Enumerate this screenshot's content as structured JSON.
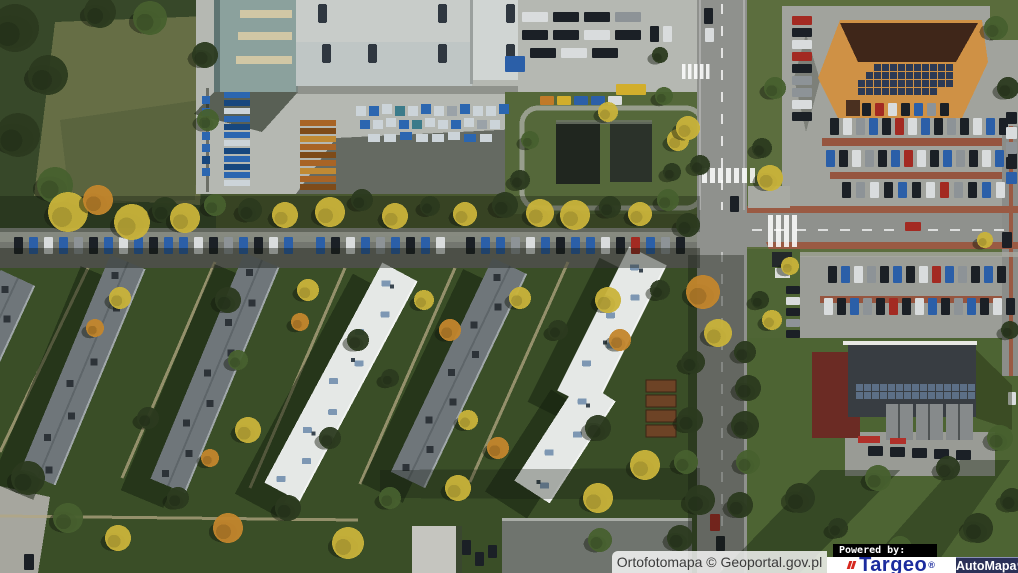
{
  "map": {
    "type": "orthophoto-aerial",
    "description": "Aerial orthophoto of a neighborhood: industrial hall with storage yard (top), main road with intersection (right), retail building with solar roof and parking lots (top right), service building with solar panels (bottom right), six diagonal apartment blocks with lawns, trees and street parking (center/left)"
  },
  "attribution": {
    "source": "Ortofotomapa © Geoportal.gov.pl",
    "powered_by": "Powered by:",
    "brand_targeo": "Targeo",
    "brand_targeo_reg": "®",
    "brand_automapa": "AutoMapa",
    "brand_automapa_reg": "®"
  },
  "colors": {
    "targeo_blue": "#1c2c9e",
    "targeo_red": "#d6281e",
    "automapa_navy": "#2b3158",
    "attribution_text": "#3b3b3b",
    "powered_by_bg": "#000000",
    "powered_by_text": "#ffffff"
  },
  "scene": {
    "palette": {
      "cars": {
        "n": "#1b2026",
        "b": "#2b5fa8",
        "w": "#d9dcdd",
        "s": "#8d9397",
        "r": "#a32a22",
        "y": "#d2ae2c",
        "o": "#c07a28"
      },
      "trees": {
        "d": "#2b3a1f",
        "m": "#47602e",
        "y": "#c9b33a",
        "o": "#c3862c",
        "l": "#6e8440"
      },
      "pallets": {
        "b": "#2b66b0",
        "B": "#17477e",
        "w": "#ccd4d9",
        "o": "#a86426",
        "O": "#7e4b19",
        "c": "#c08a34",
        "t": "#3b7b8a",
        "s": "#9aa2a8"
      }
    },
    "street_cars": {
      "y": 237,
      "w": 9,
      "h": 17,
      "xs": [
        14,
        29,
        44,
        59,
        74,
        89,
        104,
        119,
        134,
        149,
        164,
        179,
        194,
        209,
        224,
        239,
        254,
        269,
        284,
        316,
        331,
        346,
        361,
        376,
        391,
        406,
        421,
        436,
        466,
        481,
        496,
        511,
        526,
        541,
        556,
        571,
        586,
        601,
        616,
        631,
        646,
        661,
        676
      ],
      "colors": "nbwbsnbwbnbbwnsbnwbbnwbsbnbwnbbswbnbbwnrbsn"
    },
    "rows": [
      {
        "x": 830,
        "y": 118,
        "n": 14,
        "dx": 13,
        "dy": 0,
        "w": 9,
        "h": 17,
        "c": "nwsbnrwbnsnwbn"
      },
      {
        "x": 826,
        "y": 150,
        "n": 15,
        "dx": 13,
        "dy": 0,
        "w": 9,
        "h": 17,
        "c": "bnwsnbrwnbsnwbn"
      },
      {
        "x": 842,
        "y": 182,
        "n": 12,
        "dx": 14,
        "dy": 0,
        "w": 9,
        "h": 16,
        "c": "nswnbnwrsnbw"
      },
      {
        "x": 792,
        "y": 16,
        "n": 9,
        "dx": 0,
        "dy": 12,
        "w": 20,
        "h": 9,
        "c": "rnwrnsswn"
      },
      {
        "x": 862,
        "y": 103,
        "n": 7,
        "dx": 13,
        "dy": 0,
        "w": 9,
        "h": 13,
        "c": "nrwnbsn"
      },
      {
        "x": 828,
        "y": 266,
        "n": 14,
        "dx": 13,
        "dy": 0,
        "w": 9,
        "h": 17,
        "c": "nbwsnbnwrbsnbn"
      },
      {
        "x": 824,
        "y": 298,
        "n": 15,
        "dx": 13,
        "dy": 0,
        "w": 9,
        "h": 17,
        "c": "wnbsnrnwbnsbnwn"
      },
      {
        "x": 522,
        "y": 12,
        "n": 4,
        "dx": 31,
        "dy": 0,
        "w": 26,
        "h": 10,
        "c": "wnns"
      },
      {
        "x": 522,
        "y": 30,
        "n": 4,
        "dx": 31,
        "dy": 0,
        "w": 26,
        "h": 10,
        "c": "nnwn"
      },
      {
        "x": 530,
        "y": 48,
        "n": 3,
        "dx": 31,
        "dy": 0,
        "w": 26,
        "h": 10,
        "c": "nwn"
      },
      {
        "x": 540,
        "y": 96,
        "n": 5,
        "dx": 17,
        "dy": 0,
        "w": 14,
        "h": 9,
        "c": "oybbw"
      },
      {
        "x": 786,
        "y": 286,
        "n": 5,
        "dx": 0,
        "dy": 11,
        "w": 14,
        "h": 8,
        "c": "nwnsn"
      },
      {
        "x": 1006,
        "y": 112,
        "n": 5,
        "dx": 0,
        "dy": 15,
        "w": 11,
        "h": 12,
        "c": "nwsnb"
      },
      {
        "x": 868,
        "y": 446,
        "n": 5,
        "dx": 22,
        "dy": 1,
        "w": 15,
        "h": 10,
        "c": "nnnnn"
      }
    ],
    "vehicles": [
      [
        616,
        84,
        30,
        11,
        "y"
      ],
      [
        505,
        56,
        20,
        16,
        "b"
      ],
      [
        650,
        26,
        9,
        16,
        "n"
      ],
      [
        663,
        26,
        9,
        16,
        "w"
      ],
      [
        704,
        8,
        9,
        16,
        "n"
      ],
      [
        705,
        28,
        9,
        14,
        "w"
      ],
      [
        730,
        196,
        9,
        16,
        "n"
      ],
      [
        905,
        222,
        16,
        9,
        "r"
      ],
      [
        710,
        514,
        10,
        17,
        "r"
      ],
      [
        716,
        536,
        9,
        15,
        "n"
      ],
      [
        24,
        554,
        10,
        16,
        "n"
      ],
      [
        1002,
        232,
        10,
        16,
        "n"
      ],
      [
        1008,
        392,
        8,
        13,
        "w"
      ],
      [
        462,
        540,
        9,
        15,
        "n"
      ],
      [
        475,
        552,
        9,
        14,
        "n"
      ],
      [
        488,
        545,
        9,
        13,
        "n"
      ]
    ],
    "pallet_stacks": [
      {
        "x": 224,
        "y": 92,
        "n": 12,
        "dx": 0,
        "dy": 8,
        "w": 26,
        "h": 6,
        "c": "bBwbBbwBbBbw"
      },
      {
        "x": 202,
        "y": 96,
        "n": 7,
        "dx": 0,
        "dy": 12,
        "w": 8,
        "h": 8,
        "c": "bbBbbBb"
      },
      {
        "x": 300,
        "y": 120,
        "n": 9,
        "dx": 0,
        "dy": 8,
        "w": 36,
        "h": 6,
        "c": "oOcoOocoO"
      }
    ],
    "yard_items": [
      [
        356,
        106,
        10,
        10,
        "w"
      ],
      [
        369,
        106,
        10,
        10,
        "b"
      ],
      [
        382,
        104,
        10,
        10,
        "w"
      ],
      [
        395,
        106,
        10,
        10,
        "t"
      ],
      [
        408,
        106,
        10,
        10,
        "w"
      ],
      [
        421,
        104,
        10,
        10,
        "b"
      ],
      [
        434,
        106,
        10,
        10,
        "w"
      ],
      [
        447,
        106,
        10,
        10,
        "s"
      ],
      [
        460,
        104,
        10,
        10,
        "b"
      ],
      [
        473,
        106,
        10,
        10,
        "w"
      ],
      [
        486,
        106,
        10,
        10,
        "w"
      ],
      [
        499,
        104,
        10,
        10,
        "b"
      ],
      [
        360,
        120,
        10,
        9,
        "b"
      ],
      [
        373,
        120,
        10,
        9,
        "w"
      ],
      [
        386,
        118,
        10,
        9,
        "w"
      ],
      [
        399,
        120,
        10,
        9,
        "b"
      ],
      [
        412,
        120,
        10,
        9,
        "t"
      ],
      [
        425,
        118,
        10,
        9,
        "w"
      ],
      [
        438,
        120,
        10,
        9,
        "w"
      ],
      [
        451,
        120,
        10,
        9,
        "b"
      ],
      [
        464,
        118,
        10,
        9,
        "w"
      ],
      [
        477,
        120,
        10,
        9,
        "s"
      ],
      [
        490,
        120,
        10,
        9,
        "w"
      ],
      [
        368,
        134,
        12,
        8,
        "w"
      ],
      [
        384,
        134,
        12,
        8,
        "w"
      ],
      [
        400,
        132,
        12,
        8,
        "b"
      ],
      [
        416,
        134,
        12,
        8,
        "w"
      ],
      [
        432,
        134,
        12,
        8,
        "w"
      ],
      [
        448,
        132,
        12,
        8,
        "w"
      ],
      [
        464,
        134,
        12,
        8,
        "b"
      ],
      [
        480,
        134,
        12,
        8,
        "w"
      ]
    ],
    "buildings": [
      {
        "x1": 18,
        "y1": 278,
        "x2": -70,
        "y2": 468,
        "w": 38,
        "roof": "gray"
      },
      {
        "x1": 128,
        "y1": 262,
        "x2": 38,
        "y2": 478,
        "w": 38,
        "roof": "gray"
      },
      {
        "x1": 262,
        "y1": 260,
        "x2": 168,
        "y2": 486,
        "w": 38,
        "roof": "gray"
      },
      {
        "x1": 400,
        "y1": 272,
        "x2": 282,
        "y2": 492,
        "w": 40,
        "roof": "white"
      },
      {
        "x1": 510,
        "y1": 266,
        "x2": 408,
        "y2": 480,
        "w": 38,
        "roof": "gray"
      },
      {
        "x1": 648,
        "y1": 256,
        "x2": 576,
        "y2": 400,
        "w": 42,
        "roof": "white"
      },
      {
        "x1": 598,
        "y1": 390,
        "x2": 532,
        "y2": 492,
        "w": 42,
        "roof": "white"
      }
    ],
    "skylights": [
      [
        318,
        4
      ],
      [
        438,
        4
      ],
      [
        506,
        4
      ],
      [
        322,
        44
      ],
      [
        368,
        44
      ],
      [
        438,
        44
      ],
      [
        506,
        44
      ]
    ],
    "solar_orange": [
      [
        64,
        874,
        10
      ],
      [
        72,
        866,
        11
      ],
      [
        80,
        858,
        12
      ],
      [
        88,
        858,
        10
      ]
    ],
    "solar_maroon": [
      [
        384,
        856,
        15
      ],
      [
        392,
        856,
        15
      ]
    ],
    "zebras": [
      {
        "x": 702,
        "y": 168,
        "n": 7,
        "dx": 8,
        "w": 5,
        "h": 15
      },
      {
        "x": 768,
        "y": 215,
        "n": 4,
        "dx": 8,
        "w": 5,
        "h": 32
      },
      {
        "x": 682,
        "y": 64,
        "n": 5,
        "dx": 6,
        "w": 3.5,
        "h": 15
      }
    ],
    "garages": {
      "x": 646,
      "y": 380,
      "n": 4,
      "dy": 15,
      "w": 30,
      "h": 12
    },
    "paths": [
      [
        88,
        268,
        0,
        452
      ],
      [
        215,
        262,
        122,
        478
      ],
      [
        345,
        268,
        250,
        488
      ],
      [
        455,
        268,
        360,
        484
      ],
      [
        568,
        262,
        470,
        482
      ],
      [
        0,
        516,
        358,
        520
      ]
    ],
    "trees": [
      [
        15,
        28,
        24,
        "d"
      ],
      [
        48,
        75,
        20,
        "d"
      ],
      [
        18,
        135,
        22,
        "d"
      ],
      [
        55,
        185,
        18,
        "m"
      ],
      [
        100,
        12,
        16,
        "d"
      ],
      [
        150,
        18,
        17,
        "m"
      ],
      [
        205,
        55,
        13,
        "d"
      ],
      [
        208,
        120,
        11,
        "m"
      ],
      [
        68,
        212,
        20,
        "y"
      ],
      [
        98,
        200,
        15,
        "o"
      ],
      [
        132,
        222,
        18,
        "y"
      ],
      [
        165,
        210,
        13,
        "d"
      ],
      [
        185,
        218,
        15,
        "y"
      ],
      [
        215,
        205,
        11,
        "m"
      ],
      [
        250,
        210,
        12,
        "d"
      ],
      [
        285,
        215,
        13,
        "y"
      ],
      [
        330,
        212,
        15,
        "y"
      ],
      [
        362,
        200,
        11,
        "d"
      ],
      [
        395,
        216,
        13,
        "y"
      ],
      [
        430,
        206,
        10,
        "d"
      ],
      [
        465,
        214,
        12,
        "y"
      ],
      [
        505,
        205,
        13,
        "d"
      ],
      [
        540,
        213,
        14,
        "y"
      ],
      [
        575,
        215,
        15,
        "y"
      ],
      [
        610,
        207,
        11,
        "d"
      ],
      [
        640,
        214,
        12,
        "y"
      ],
      [
        668,
        200,
        11,
        "m"
      ],
      [
        688,
        225,
        12,
        "d"
      ],
      [
        120,
        298,
        11,
        "y"
      ],
      [
        95,
        328,
        9,
        "o"
      ],
      [
        228,
        300,
        13,
        "d"
      ],
      [
        308,
        290,
        11,
        "y"
      ],
      [
        300,
        322,
        9,
        "o"
      ],
      [
        358,
        340,
        11,
        "d"
      ],
      [
        424,
        300,
        10,
        "y"
      ],
      [
        450,
        330,
        11,
        "o"
      ],
      [
        390,
        378,
        9,
        "d"
      ],
      [
        520,
        298,
        11,
        "y"
      ],
      [
        558,
        330,
        10,
        "d"
      ],
      [
        608,
        300,
        13,
        "y"
      ],
      [
        620,
        340,
        11,
        "o"
      ],
      [
        660,
        290,
        10,
        "d"
      ],
      [
        238,
        360,
        10,
        "m"
      ],
      [
        148,
        418,
        11,
        "d"
      ],
      [
        248,
        430,
        13,
        "y"
      ],
      [
        210,
        458,
        9,
        "o"
      ],
      [
        330,
        438,
        11,
        "d"
      ],
      [
        468,
        420,
        10,
        "y"
      ],
      [
        498,
        448,
        11,
        "o"
      ],
      [
        598,
        428,
        13,
        "d"
      ],
      [
        645,
        465,
        15,
        "y"
      ],
      [
        28,
        478,
        17,
        "d"
      ],
      [
        68,
        518,
        15,
        "m"
      ],
      [
        118,
        538,
        13,
        "y"
      ],
      [
        178,
        498,
        11,
        "d"
      ],
      [
        228,
        528,
        15,
        "o"
      ],
      [
        288,
        508,
        13,
        "d"
      ],
      [
        348,
        543,
        16,
        "y"
      ],
      [
        390,
        498,
        11,
        "m"
      ],
      [
        458,
        488,
        13,
        "y"
      ],
      [
        598,
        498,
        15,
        "y"
      ],
      [
        680,
        538,
        13,
        "d"
      ],
      [
        600,
        540,
        12,
        "m"
      ],
      [
        703,
        292,
        17,
        "o"
      ],
      [
        718,
        333,
        14,
        "y"
      ],
      [
        693,
        362,
        12,
        "d"
      ],
      [
        745,
        352,
        11,
        "d"
      ],
      [
        748,
        388,
        13,
        "d"
      ],
      [
        745,
        425,
        14,
        "d"
      ],
      [
        748,
        462,
        12,
        "m"
      ],
      [
        690,
        420,
        13,
        "d"
      ],
      [
        686,
        462,
        12,
        "m"
      ],
      [
        700,
        500,
        15,
        "d"
      ],
      [
        740,
        505,
        13,
        "d"
      ],
      [
        770,
        178,
        13,
        "y"
      ],
      [
        762,
        148,
        10,
        "d"
      ],
      [
        775,
        88,
        11,
        "m"
      ],
      [
        678,
        140,
        11,
        "y"
      ],
      [
        672,
        172,
        9,
        "d"
      ],
      [
        664,
        96,
        9,
        "m"
      ],
      [
        660,
        55,
        8,
        "d"
      ],
      [
        790,
        266,
        9,
        "y"
      ],
      [
        760,
        300,
        9,
        "d"
      ],
      [
        772,
        320,
        10,
        "y"
      ],
      [
        996,
        28,
        12,
        "m"
      ],
      [
        1008,
        88,
        11,
        "d"
      ],
      [
        1010,
        330,
        9,
        "d"
      ],
      [
        985,
        240,
        8,
        "y"
      ],
      [
        800,
        498,
        15,
        "d"
      ],
      [
        878,
        478,
        13,
        "m"
      ],
      [
        948,
        468,
        12,
        "d"
      ],
      [
        1000,
        438,
        13,
        "m"
      ],
      [
        978,
        528,
        15,
        "d"
      ],
      [
        900,
        548,
        12,
        "m"
      ],
      [
        838,
        528,
        10,
        "d"
      ],
      [
        1012,
        500,
        12,
        "d"
      ],
      [
        608,
        112,
        10,
        "y"
      ],
      [
        688,
        128,
        12,
        "y"
      ],
      [
        530,
        140,
        9,
        "m"
      ],
      [
        520,
        180,
        10,
        "d"
      ],
      [
        700,
        165,
        10,
        "d"
      ]
    ]
  }
}
